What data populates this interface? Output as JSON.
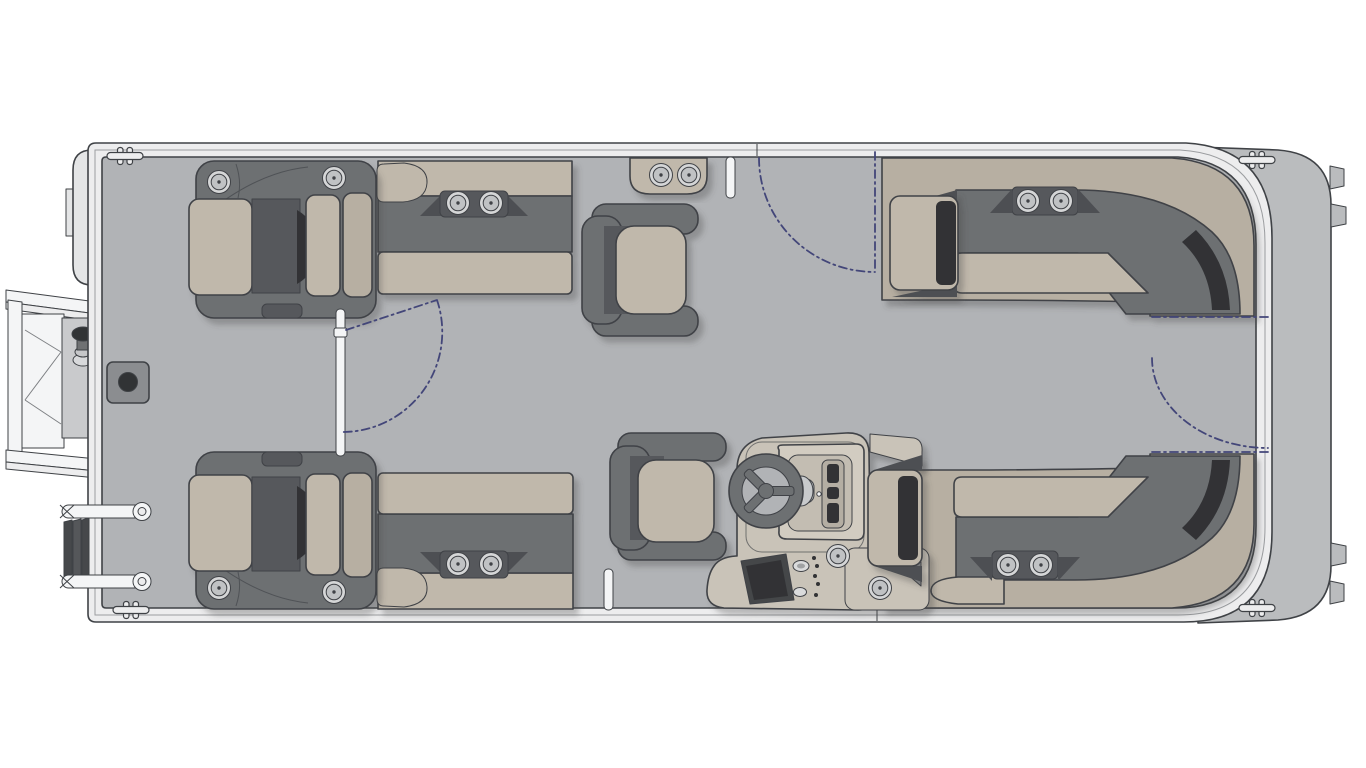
{
  "diagram": {
    "title": "Pontoon boat floor plan - top-down view",
    "type": "boat-floorplan",
    "visible_text": [],
    "orientation": {
      "bow": "right",
      "stern": "left"
    },
    "features": [
      {
        "id": "hull",
        "label": "Pontoon hull with perimeter fence rail"
      },
      {
        "id": "bow-deck",
        "label": "Bow platform with pontoon nose tabs (right end)"
      },
      {
        "id": "motor-pod",
        "label": "Motor / nose pod (left end)"
      },
      {
        "id": "boarding-door",
        "label": "Boarding door shown swung open, with tow pylon knob (left)",
        "state": "open"
      },
      {
        "id": "boarding-ladder",
        "label": "Folded boarding ladder (lower left)"
      },
      {
        "id": "table-pedestal-base",
        "label": "Table pedestal floor base"
      },
      {
        "id": "recliner-upper",
        "label": "Upper chaise recliner with 2 cup holders"
      },
      {
        "id": "recliner-lower",
        "label": "Lower chaise recliner with 2 cup holders"
      },
      {
        "id": "bench-upper",
        "label": "Upper side bench with 2 cup holders"
      },
      {
        "id": "bench-lower",
        "label": "Lower side bench with 2 cup holders"
      },
      {
        "id": "swivel-chair-upper",
        "label": "Upper swivel captain chair"
      },
      {
        "id": "swivel-chair-lower",
        "label": "Lower swivel captain chair"
      },
      {
        "id": "cupholder-console",
        "label": "Top rail cup-holder console (2 cup holders)"
      },
      {
        "id": "helm-console",
        "label": "Helm console with steering wheel, gauge screen, switch panel and 2 cup holders"
      },
      {
        "id": "l-lounge-upper",
        "label": "Upper L-shaped corner lounge with armrest and 2 cup holders"
      },
      {
        "id": "l-lounge-lower",
        "label": "Lower L-shaped corner lounge with armrest and 2 cup holders"
      },
      {
        "id": "gate-center",
        "label": "Center walkway gate with swing arc"
      },
      {
        "id": "gate-upper",
        "label": "Upper side gate with swing arc"
      },
      {
        "id": "gate-lower",
        "label": "Lower side gate post"
      },
      {
        "id": "gate-bow",
        "label": "Bow walkway gate with swing arcs (right end)"
      },
      {
        "id": "cleats",
        "label": "4 mooring cleats"
      }
    ],
    "counts": {
      "cup_holders": 14,
      "swivel_chairs": 2,
      "recliners": 2,
      "benches": 2,
      "l_lounges": 2,
      "gates": 4,
      "cleats": 4
    }
  },
  "colors": {
    "bg": "#ffffff",
    "rail": "#ededee",
    "deck": "#b1b3b6",
    "bowdeck": "#babcbe",
    "pod": "#e4e5e6",
    "tan": "#c0b8ab",
    "tan2": "#b7afa2",
    "gray": "#6d6f72",
    "gray2": "#57595c",
    "charcoal": "#313335",
    "outline": "#3f4246",
    "cupring": "#d5d6d7",
    "cupinner": "#c0c2c4",
    "helm": "#c9c3b8",
    "helm2": "#d2ccc1",
    "panel": "#45474a",
    "wedge": "#4e5053",
    "white": "#f4f5f6",
    "dash": "#434679"
  }
}
